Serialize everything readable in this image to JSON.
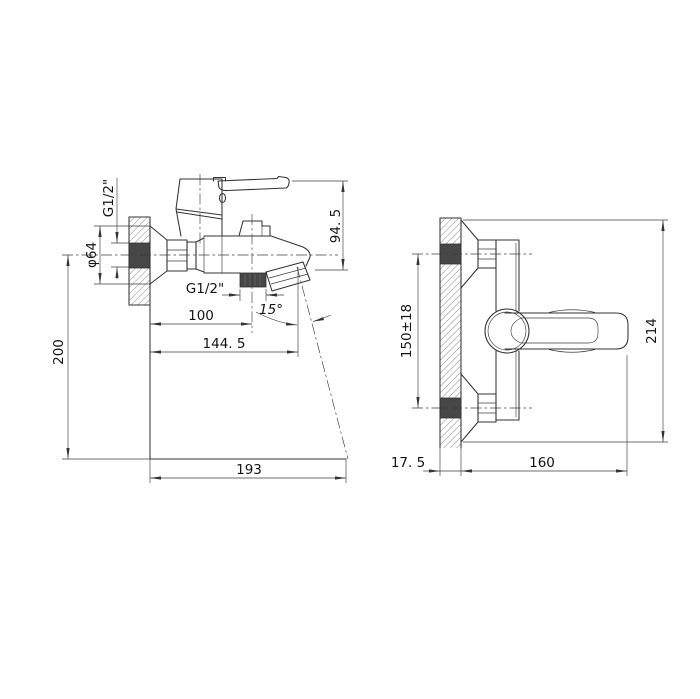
{
  "palette": {
    "line": "#333333",
    "dark_fill": "#474747",
    "background": "#ffffff"
  },
  "views": {
    "side_view": {
      "label": "side view",
      "dimensions": {
        "wall_thread": "G1/2\"",
        "flange_diameter": "φ64",
        "handle_height": "94. 5",
        "shower_outlet_thread": "G1/2\"",
        "shower_outlet_offset": "100",
        "spout_angle": "15°",
        "spout_offset": "144. 5",
        "mount_height": "200",
        "stream_reach": "193"
      }
    },
    "front_view": {
      "label": "front view",
      "dimensions": {
        "inlet_spacing": "150±18",
        "overall_length": "214",
        "wall_offset": "17. 5",
        "body_length": "160"
      }
    }
  }
}
